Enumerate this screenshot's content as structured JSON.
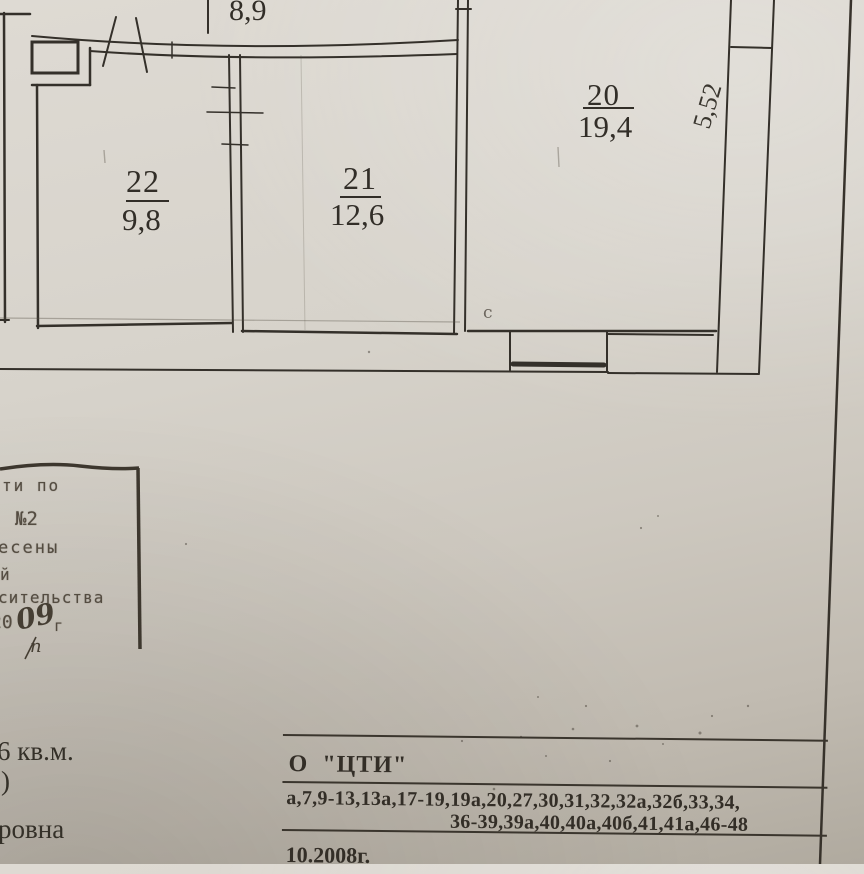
{
  "colors": {
    "paper": "#d6d2c9",
    "ink": "#34302a"
  },
  "floor_plan": {
    "room_top_area": "8,9",
    "rooms": [
      {
        "number": "22",
        "area": "9,8"
      },
      {
        "number": "21",
        "area": "12,6"
      },
      {
        "number": "20",
        "area": "19,4"
      }
    ],
    "wall_dimension": "5,52",
    "pencil_mark": "с"
  },
  "stamp": {
    "line1": "ти  по",
    "line2": "№2",
    "line3": "есены",
    "line4": "й",
    "line5": "сительства",
    "year_printed": "20",
    "year_handwritten": "09",
    "year_suffix": "г",
    "note_handwritten": "п"
  },
  "left_column": {
    "area_fragment": "6 кв.м.",
    "paren_fragment": ")",
    "name_fragment": "ровна"
  },
  "cti_block": {
    "org_line": "О  \"ЦТИ\"",
    "apartments_line1": "а,7,9-13,13а,17-19,19а,20,27,30,31,32,32а,32б,33,34,",
    "apartments_line2": "36-39,39а,40,40а,40б,41,41а,46-48",
    "date_line": "10.2008г."
  }
}
